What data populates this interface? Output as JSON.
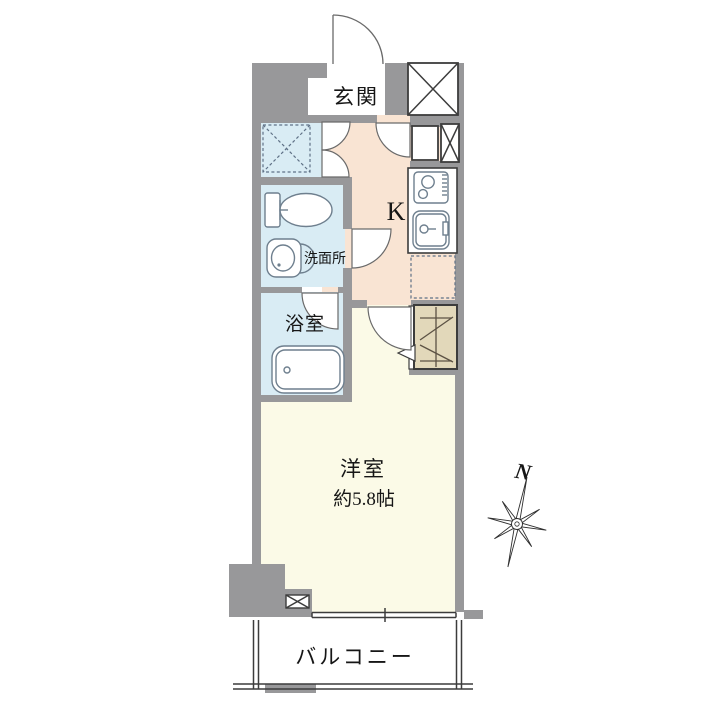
{
  "floorplan": {
    "rooms": {
      "entrance": {
        "label": "玄関"
      },
      "kitchen": {
        "label": "K"
      },
      "washroom": {
        "label": "洗面所"
      },
      "bathroom": {
        "label": "浴室"
      },
      "living": {
        "label": "洋室",
        "size": "約5.8帖"
      },
      "balcony": {
        "label": "バルコニー"
      }
    },
    "compass": {
      "north": "N"
    },
    "colors": {
      "wall": "#98989a",
      "kitchen_floor": "#f9e4d3",
      "wet_area_floor": "#d9ecf4",
      "room_floor": "#fbfae7",
      "closet_floor": "#e2d8ba",
      "genkan_floor": "#ffffff",
      "fixture_line": "#6e7f8e",
      "outline": "#3c3c3c",
      "text": "#161616"
    }
  }
}
